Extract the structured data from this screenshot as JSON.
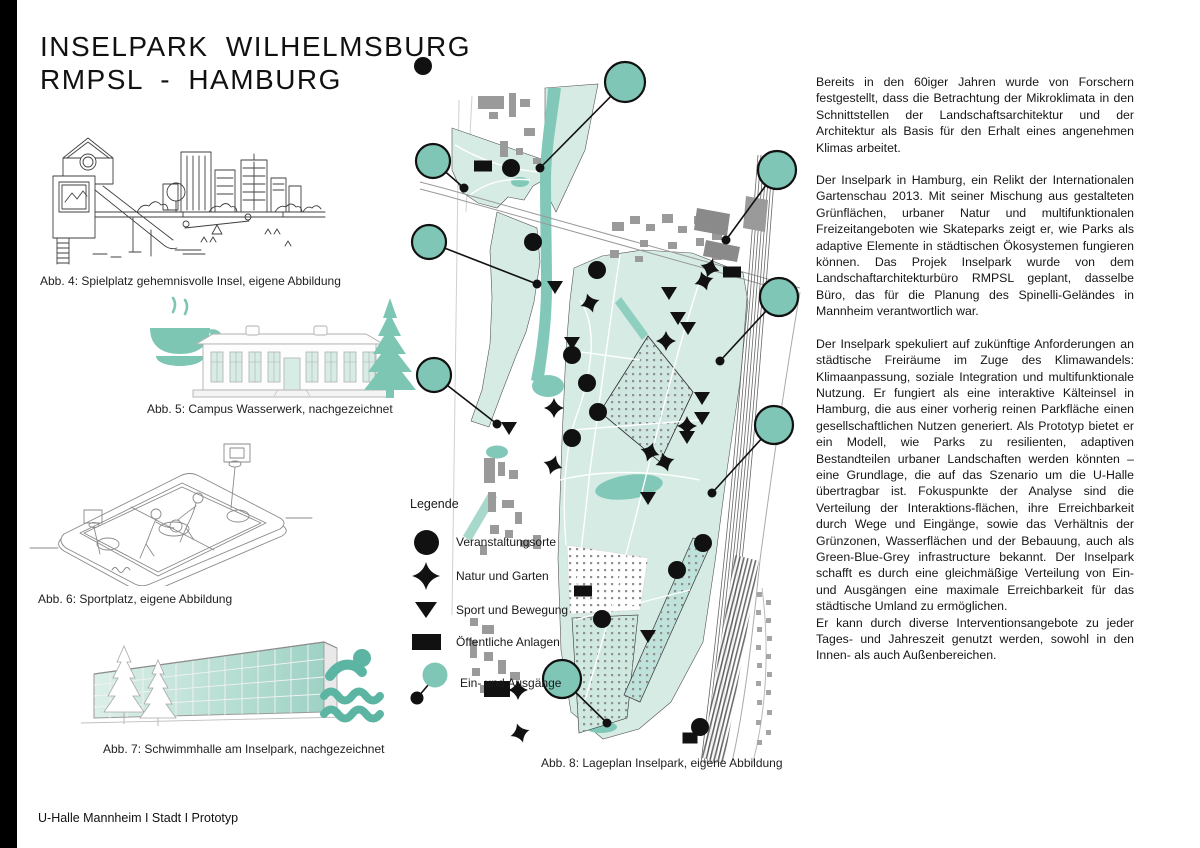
{
  "header": {
    "title_line1": "INSELPARK WILHELMSBURG",
    "title_line2": "RMPSL - HAMBURG"
  },
  "footer": {
    "text": "U-Halle Mannheim I Stadt I Prototyp"
  },
  "figures": {
    "fig4_caption": "Abb. 4: Spielplatz gehemnisvolle Insel, eigene Abbildung",
    "fig5_caption": "Abb. 5: Campus Wasserwerk, nachgezeichnet",
    "fig6_caption": "Abb. 6: Sportplatz, eigene Abbildung",
    "fig7_caption": "Abb. 7: Schwimmhalle am Inselpark, nachgezeichnet",
    "fig8_caption": "Abb. 8: Lageplan Inselpark, eigene Abbildung"
  },
  "legend": {
    "title": "Legende",
    "items": [
      {
        "icon": "venue-circle-icon",
        "label": "Veranstaltungsorte"
      },
      {
        "icon": "nature-star-icon",
        "label": "Natur und Garten"
      },
      {
        "icon": "sport-triangle-icon",
        "label": "Sport und Bewegung"
      },
      {
        "icon": "public-square-icon",
        "label": "Öffentliche Anlagen"
      },
      {
        "icon": "entrance-circle-icon",
        "label": "Ein- und Ausgänge"
      }
    ]
  },
  "article": {
    "paragraphs": [
      "Bereits in den 60iger Jahren wurde von Forschern festgestellt, dass die Betrachtung der Mikroklimata in den Schnittstellen der Landschaftsarchitektur und der Architektur als Basis für den Erhalt eines angenehmen Klimas arbeitet.",
      "Der Inselpark in Hamburg, ein Relikt der Internationalen Gartenschau 2013. Mit seiner Mischung aus gestalteten Grünflächen, urbaner Natur und multifunktionalen Freizeitangeboten wie Skateparks zeigt er, wie Parks als adaptive Elemente in städtischen Ökosystemen fungieren können. Das Projek Inselpark wurde von dem Landschaftarchitekturbüro RMPSL geplant, dasselbe Büro, das für die Planung des Spinelli-Geländes in Mannheim verantwortlich war.",
      "Der Inselpark spekuliert auf zukünftige Anforderungen an städtische Freiräume im Zuge des Klimawandels: Klimaanpassung, soziale Integration und multifunktionale Nutzung. Er fungiert als eine interaktive Kälteinsel in Hamburg, die aus einer vorherig reinen Parkfläche einen gesellschaftlichen Nutzen generiert. Als Prototyp bietet er ein Modell, wie Parks zu resilienten, adaptiven Bestandteilen urbaner Landschaften werden könnten – eine Grundlage, die auf das Szenario um die U-Halle übertragbar ist. Fokuspunkte der Analyse sind die Verteilung der Interaktions-flächen, ihre Erreichbarkeit durch Wege und Eingänge, sowie das Verhältnis der Grünzonen, Wasserflächen und der Bebauung, auch als Green-Blue-Grey infrastructure bekannt. Der Inselpark schafft es durch eine gleichmäßige Verteilung von Ein- und Ausgängen eine maximale Erreichbarkeit für das städtische Umland zu ermöglichen.",
      "Er kann durch diverse Interventionsangebote zu jeder Tages- und Jahreszeit genutzt werden, sowohl in den Innen- als auch Außenbereichen."
    ]
  },
  "colors": {
    "teal": "#7fc6b6",
    "teal_water": "#82c8b8",
    "teal_light": "#d5ebe4",
    "building_gray": "#9a9a9a",
    "ink": "#111111"
  },
  "map": {
    "entrances": [
      {
        "cx": 625,
        "cy": 82,
        "r": 20,
        "ex": 540,
        "ey": 168
      },
      {
        "cx": 433,
        "cy": 161,
        "r": 17,
        "ex": 464,
        "ey": 188
      },
      {
        "cx": 429,
        "cy": 242,
        "r": 17,
        "ex": 537,
        "ey": 284
      },
      {
        "cx": 777,
        "cy": 170,
        "r": 19,
        "ex": 726,
        "ey": 240
      },
      {
        "cx": 779,
        "cy": 297,
        "r": 19,
        "ex": 720,
        "ey": 361
      },
      {
        "cx": 434,
        "cy": 375,
        "r": 17,
        "ex": 497,
        "ey": 424
      },
      {
        "cx": 774,
        "cy": 425,
        "r": 19,
        "ex": 712,
        "ey": 493
      },
      {
        "cx": 562,
        "cy": 679,
        "r": 19,
        "ex": 607,
        "ey": 723
      }
    ],
    "venues": [
      [
        423,
        66
      ],
      [
        511,
        168
      ],
      [
        533,
        242
      ],
      [
        597,
        270
      ],
      [
        572,
        355
      ],
      [
        587,
        383
      ],
      [
        598,
        412
      ],
      [
        572,
        438
      ],
      [
        703,
        543
      ],
      [
        677,
        570
      ],
      [
        602,
        619
      ],
      [
        700,
        727
      ]
    ],
    "nature": [
      [
        590,
        303
      ],
      [
        666,
        341
      ],
      [
        710,
        268
      ],
      [
        704,
        281
      ],
      [
        687,
        426
      ],
      [
        650,
        452
      ],
      [
        665,
        462
      ],
      [
        554,
        408
      ],
      [
        553,
        465
      ],
      [
        520,
        733
      ],
      [
        518,
        690
      ]
    ],
    "sport": [
      [
        555,
        287
      ],
      [
        669,
        293
      ],
      [
        678,
        318
      ],
      [
        688,
        328
      ],
      [
        572,
        343
      ],
      [
        702,
        398
      ],
      [
        702,
        418
      ],
      [
        687,
        437
      ],
      [
        648,
        498
      ],
      [
        648,
        636
      ],
      [
        509,
        428
      ]
    ],
    "public": [
      {
        "x": 483,
        "y": 166,
        "w": 18,
        "h": 11
      },
      {
        "x": 732,
        "y": 272,
        "w": 18,
        "h": 11
      },
      {
        "x": 583,
        "y": 591,
        "w": 18,
        "h": 11
      },
      {
        "x": 690,
        "y": 738,
        "w": 15,
        "h": 11
      },
      {
        "x": 497,
        "y": 689,
        "w": 26,
        "h": 16
      }
    ]
  }
}
